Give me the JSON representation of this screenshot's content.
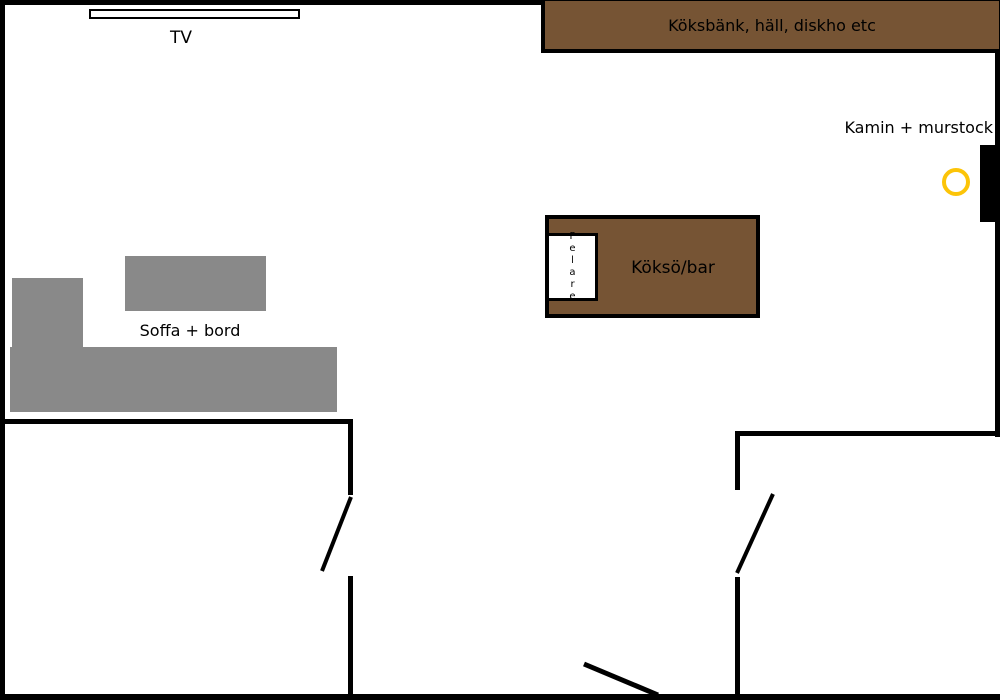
{
  "figure": {
    "type": "floor-plan",
    "labels": {
      "tv": "TV",
      "kitchen_bench": "Köksbänk, häll, diskho etc",
      "fireplace": "Kamin + murstock",
      "kitchen_island": "Köksö/bar",
      "pillar": "Pelare",
      "sofa_table": "Soffa + bord"
    },
    "colors": {
      "furniture-brown": "#765434",
      "sofa-gray": "#898989",
      "marker-yellow": "#fcc408",
      "line-black": "#000000"
    }
  }
}
